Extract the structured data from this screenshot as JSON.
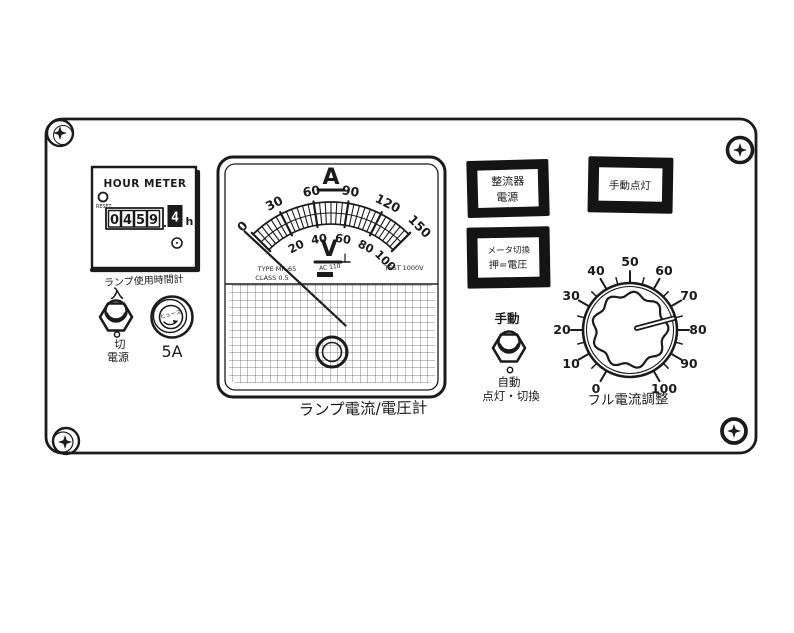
{
  "panel": {
    "hour_meter": {
      "title": "HOUR METER",
      "reset_label": "RESET",
      "digits": [
        "0",
        "4",
        "5",
        "9"
      ],
      "decimal_digit": "4",
      "unit": "h",
      "caption": "ランプ使用時間計"
    },
    "power_switch": {
      "on_label": "入",
      "off_label": "切",
      "caption": "電源"
    },
    "fuse": {
      "cap_label": "ヒューズ",
      "rating": "5A"
    },
    "meter": {
      "ammeter_symbol": "A",
      "voltmeter_symbol": "V",
      "a_scale": [
        "0",
        "30",
        "60",
        "90",
        "120",
        "150"
      ],
      "v_scale": [
        "20",
        "40",
        "60",
        "80",
        "100"
      ],
      "needle_value": 0,
      "type_text": "TYPE MR-65",
      "class_text": "CLASS 0.5",
      "aux_text": "AC 110",
      "test_text": "TEST 1000V",
      "caption": "ランプ電流/電圧計"
    },
    "lamp_rectifier": {
      "line1": "整流器",
      "line2": "電源"
    },
    "lamp_manual": {
      "label": "手動点灯"
    },
    "button_meter_select": {
      "line1": "メータ切換",
      "line2": "押=電圧"
    },
    "mode_switch": {
      "top_label": "手動",
      "bottom_label": "自動",
      "caption": "点灯・切換"
    },
    "dial": {
      "ticks": [
        "0",
        "10",
        "20",
        "30",
        "40",
        "50",
        "60",
        "70",
        "80",
        "90",
        "100"
      ],
      "pointer_value": 75,
      "caption": "フル電流調整"
    }
  }
}
